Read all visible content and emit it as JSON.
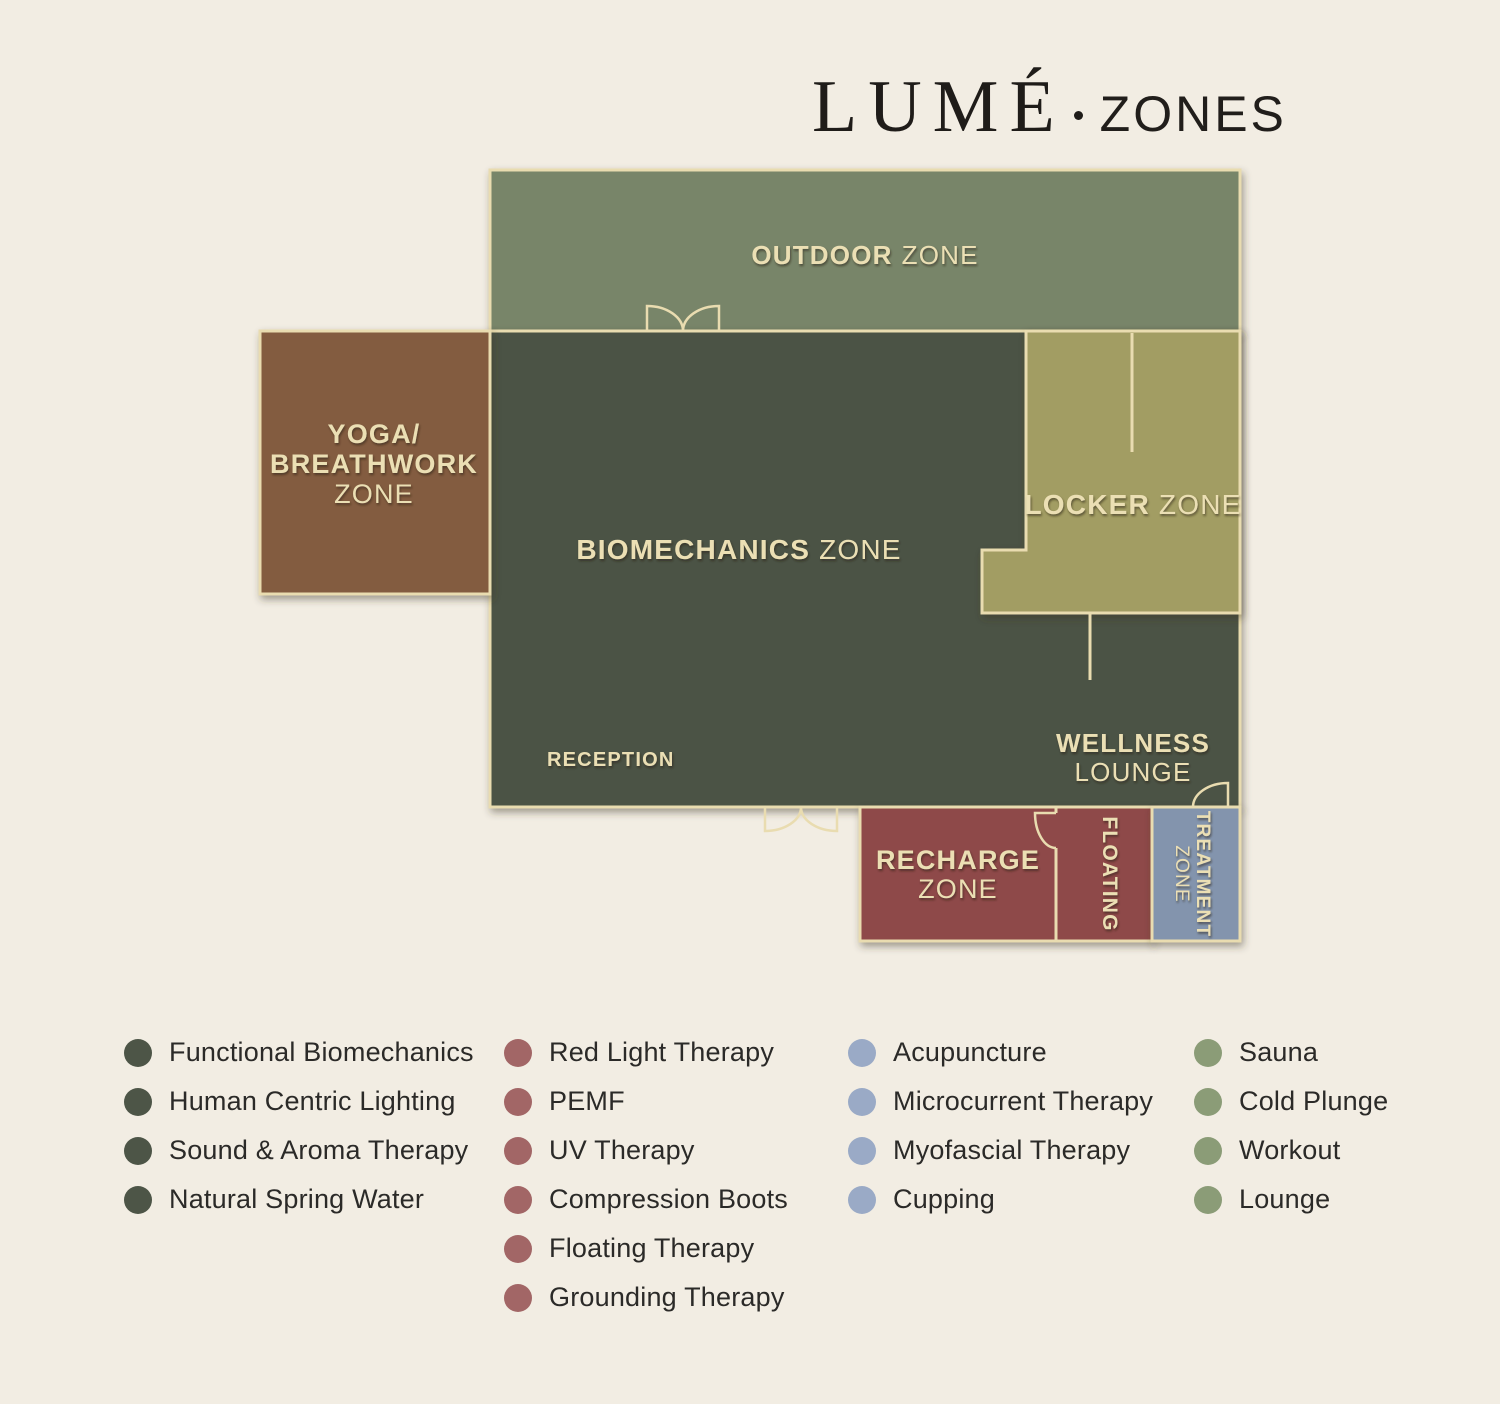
{
  "title": {
    "brand": "LUMÉ",
    "separator": "·",
    "suffix": "ZONES"
  },
  "plan": {
    "background_color": "#f2ede3",
    "wall_color": "#e9dcb0",
    "label_color": "#ebdfb4",
    "zones": {
      "outdoor": {
        "label_bold": "OUTDOOR",
        "label_light": "ZONE",
        "color": "#788569"
      },
      "yoga": {
        "line1": "YOGA/",
        "line2": "BREATHWORK",
        "line3": "ZONE",
        "color": "#835c3f"
      },
      "biomechanics": {
        "label_bold": "BIOMECHANICS",
        "label_light": "ZONE",
        "color": "#4b5245"
      },
      "locker": {
        "label_bold": "LOCKER",
        "label_light": "ZONE",
        "color": "#a29d63"
      },
      "wellness": {
        "line1": "WELLNESS",
        "line2": "LOUNGE"
      },
      "reception": {
        "label": "RECEPTION"
      },
      "recharge": {
        "line1": "RECHARGE",
        "line2": "ZONE",
        "color": "#8e4a48"
      },
      "floating": {
        "label": "FLOATING"
      },
      "treatment": {
        "line1": "TREATMENT",
        "line2": "ZONE",
        "color": "#8394ad"
      }
    }
  },
  "legend": {
    "columns": [
      {
        "dot_color": "#4d5547",
        "items": [
          "Functional Biomechanics",
          "Human Centric Lighting",
          "Sound & Aroma Therapy",
          "Natural Spring Water"
        ]
      },
      {
        "dot_color": "#a26666",
        "items": [
          "Red Light Therapy",
          "PEMF",
          "UV Therapy",
          "Compression Boots",
          "Floating Therapy",
          "Grounding Therapy"
        ]
      },
      {
        "dot_color": "#9aaac6",
        "items": [
          "Acupuncture",
          "Microcurrent Therapy",
          "Myofascial Therapy",
          "Cupping"
        ]
      },
      {
        "dot_color": "#8b9c77",
        "items": [
          "Sauna",
          "Cold Plunge",
          "Workout",
          "Lounge"
        ]
      }
    ]
  }
}
